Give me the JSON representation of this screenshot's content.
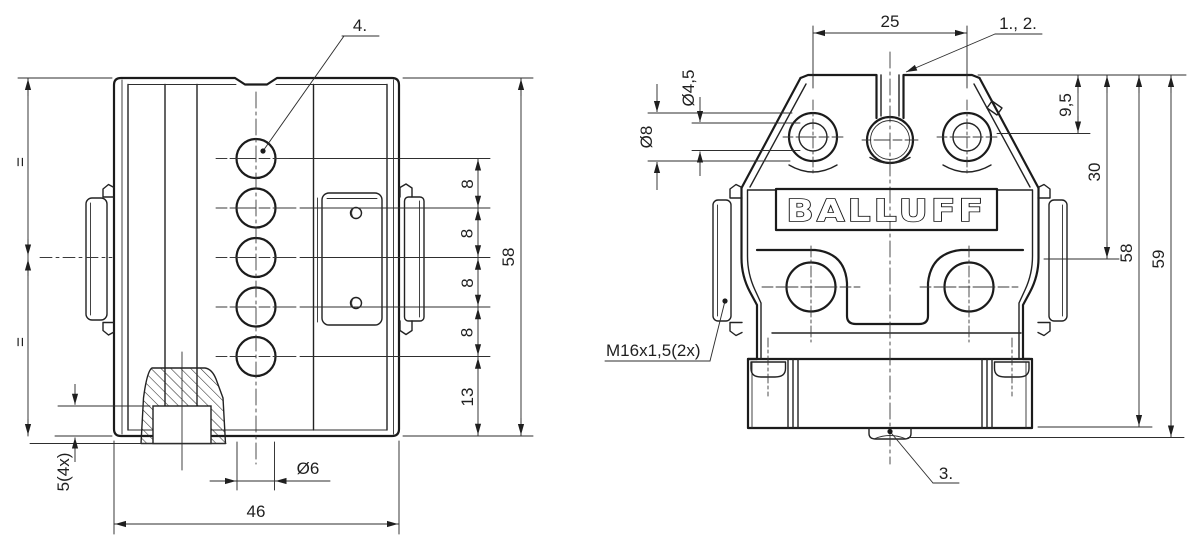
{
  "drawing": {
    "background": "#ffffff",
    "line_color": "#1b1b1b",
    "left_view": {
      "callout_4": "4.",
      "equal_top": "=",
      "equal_bottom": "=",
      "dim_width": "46",
      "dim_height": "58",
      "dim_hole_spacing": [
        "8",
        "8",
        "8",
        "8"
      ],
      "dim_bottom_offset": "13",
      "dim_hole_dia": "Ø6",
      "dim_foot": "5(4x)"
    },
    "right_view": {
      "logo": "BALLUFF",
      "callout_1_2": "1., 2.",
      "callout_3": "3.",
      "dim_top_holes": "25",
      "dim_hole_depth": "9,5",
      "dim_lower_holes": "30",
      "dim_height": "58",
      "dim_total_height": "59",
      "dim_hole_dia_inner": "Ø4,5",
      "dim_hole_dia_outer": "Ø8",
      "thread_label": "M16x1,5(2x)"
    }
  }
}
